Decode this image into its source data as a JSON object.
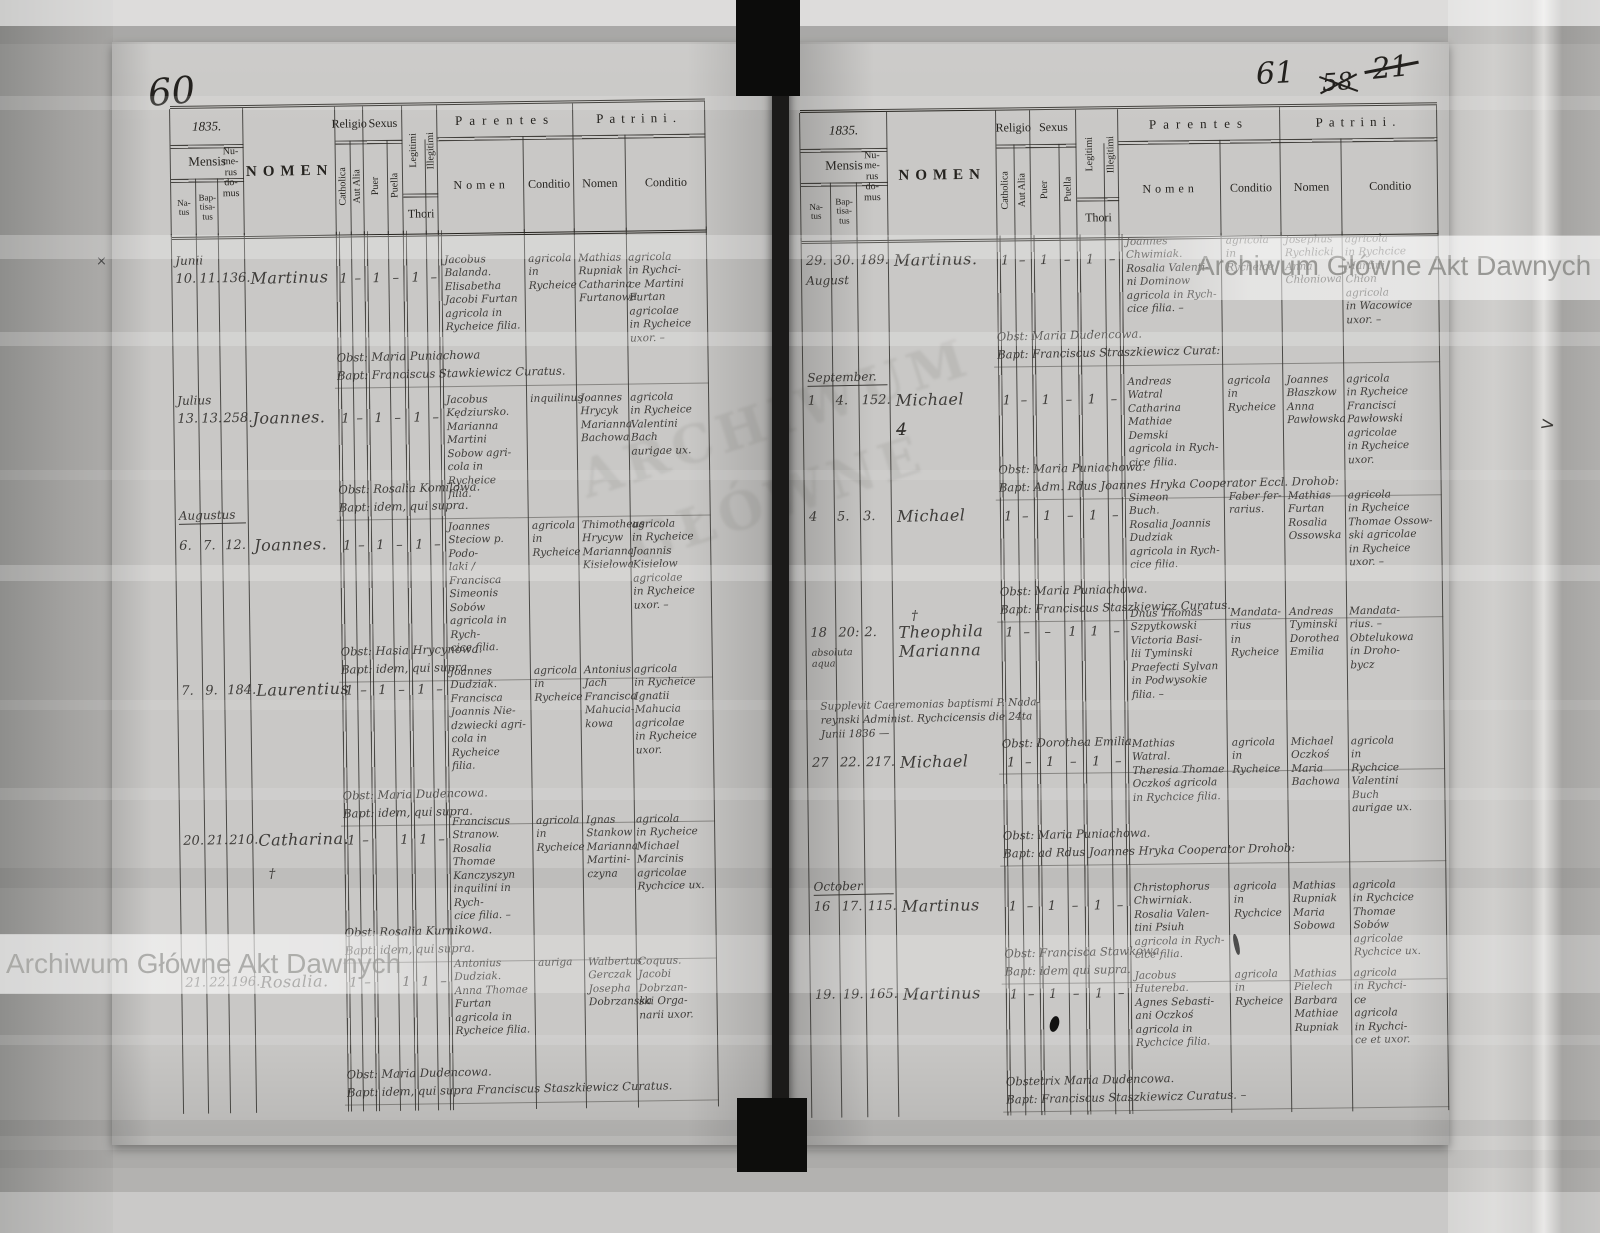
{
  "document": {
    "kind": "scanned parish baptism register, two-page spread",
    "watermark": "Archiwum Główne Akt Dawnych",
    "stamp_text": "ARCHIWUM\nGŁÓWNE",
    "page_numbers": {
      "left": "60",
      "right": "61",
      "right_old_crossed": "58",
      "right_old2_crossed": "21"
    },
    "marks": {
      "pencil_x": "×",
      "crossed_numeral": "4̶",
      "edge_mark": ">"
    },
    "header": {
      "mensis": "Mensis",
      "natus": "Na-\ntus",
      "baptisatus": "Bap-\ntisa-\ntus",
      "numerus": "Nu-\nme-\nrus\ndo-\nmus",
      "nomen": "NOMEN",
      "religio": "Religio",
      "catholica": "Catholica",
      "aut_alia": "Aut Alia",
      "sexus": "Sexus",
      "puer": "Puer",
      "puella": "Puella",
      "legitimi": "Legitimi",
      "illegitimi": "Illegitimi",
      "thori": "Thori",
      "parentes": "Parentes",
      "patrini": "Patrini.",
      "sub_nomen": "Nomen",
      "sub_conditio": "Conditio"
    },
    "pages": {
      "left": {
        "year": "1835.",
        "records": [
          {
            "month": "Junii",
            "month_top": 20,
            "natus": "10.",
            "bapt": "11.",
            "house": "136.",
            "name": "Martinus",
            "num_top": 38,
            "flags": [
              "1",
              "–",
              "1",
              "–",
              "1",
              "–"
            ],
            "par_nomen": "Jacobus\nBalanda.\nElisabetha\nJacobi Furtan\nagricola in\nRycheice filia.",
            "par_cond": "agricola\nin\nRycheice",
            "pat_nomen": "Mathias\nRupniak\nCatharina\nFurtanowa",
            "pat_cond": "agricola\nin Rychci-\nce Martini\nFurtan\nagricolae\nin Rycheice\nuxor. –",
            "note": "Obst: Maria Puniachowa\nBapt: Franciscus Stawkiewicz Curatus.",
            "note_top": 118
          },
          {
            "month": "Julius",
            "month_top": 160,
            "natus": "13.",
            "bapt": "13.",
            "house": "258.",
            "name": "Joannes.",
            "num_top": 178,
            "flags": [
              "1",
              "–",
              "1",
              "–",
              "1",
              "–"
            ],
            "par_nomen": "Jacobus\nKędziursko.\nMarianna\nMartini\nSobow agri-\ncola in Rycheice\nfilia.",
            "par_cond": "inquilinus",
            "pat_nomen": "Joannes\nHrycyk\nMarianna\nBachowa",
            "pat_cond": "agricola\nin Rycheice\nValentini\nBach\naurigae ux.",
            "note": "Obst: Rosalia Komilowa.\nBapt: idem, qui supra.",
            "note_top": 250
          },
          {
            "month": "Augustus",
            "month_ul": true,
            "month_top": 275,
            "natus": "6.",
            "bapt": "7.",
            "house": "12.",
            "name": "Joannes.",
            "num_top": 305,
            "flags": [
              "1",
              "–",
              "1",
              "–",
              "1",
              "–"
            ],
            "par_nomen": "Joannes\nSteciow p. Podo-\nlaki /\nFrancisca\nSimeonis\nSobów\nagricola in Rych-\ncice filia.",
            "par_cond": "agricola\nin\nRycheice",
            "pat_nomen": "Thimotheus\nHrycyw\nMarianna\nKisielowa",
            "pat_cond": "agricola\nin Rycheice\nJoannis\nKisielow\nagricolae\nin Rycheice\nuxor. –",
            "note": "Obst: Hasia Hrycynowa.\nBapt: idem, qui supra.",
            "note_top": 412
          },
          {
            "natus": "7.",
            "bapt": "9.",
            "house": "184.",
            "name": "Laurentius",
            "num_top": 450,
            "flags": [
              "1",
              "–",
              "1",
              "–",
              "1",
              "–"
            ],
            "par_nomen": "Joannes\nDudziak.\nFrancisca\nJoannis Nie-\ndzwiecki agri-\ncola in Rycheice\nfilia.",
            "par_cond": "agricola\nin\nRycheice",
            "pat_nomen": "Antonius\nJach\nFrancisca\nMahucia-\nkowa",
            "pat_cond": "agricola\nin Rycheice\nIgnatii\nMahucia\nagricolae\nin Rycheice\nuxor.",
            "note": "Obst: Maria Dudencowa.\nBapt: idem, qui supra.",
            "note_top": 556
          },
          {
            "natus": "20.",
            "bapt": "21.",
            "house": "210.",
            "name": "Catharina.",
            "num_top": 600,
            "cross": "†",
            "cross_pos": "below",
            "flags": [
              "1",
              "–",
              "",
              "1",
              "1",
              "–"
            ],
            "par_nomen": "Franciscus\nStranow.\nRosalia Thomae\nKanczyszyn\ninquilini in Rych-\ncice filia. –",
            "par_cond": "agricola\nin\nRycheice",
            "pat_nomen": "Ignas\nStankow\nMarianna\nMartini-\nczyna",
            "pat_cond": "agricola\nin Rycheice\nMichael\nMarcinis\nagricolae\nRychcice ux.",
            "note": "Obst: Rosalia Kurnikowa.\nBapt: idem, qui supra.",
            "note_top": 693
          },
          {
            "natus": "21.",
            "bapt": "22.",
            "house": "196.",
            "name": "Rosalia.",
            "num_top": 742,
            "flags": [
              "1",
              "–",
              "",
              "1",
              "1",
              "–"
            ],
            "par_nomen": "Antonius\nDudziak.\nAnna Thomae\nFurtan\nagricola in\nRycheice filia.",
            "par_cond": "auriga",
            "pat_nomen": "Walbertus\nGerczak\nJosepha\nDobrzanska",
            "pat_cond": "Coquus.\nJacobi\nDobrzan-\nski Orga-\nnarii uxor.",
            "note": "Obst: Maria Dudencowa.\nBapt: idem, qui supra Franciscus Staszkiewicz Curatus.",
            "note_top": 835
          }
        ]
      },
      "right": {
        "year": "1835.",
        "records": [
          {
            "natus": "29.",
            "bapt": "30.",
            "month": "August",
            "month_top": 36,
            "house": "189.",
            "name": "Martinus.",
            "num_top": 16,
            "flags": [
              "1",
              "–",
              "1",
              "–",
              "1",
              "–"
            ],
            "par_nomen": "Joannes\nChwimiak.\nRosalia Valenti-\nni Dominow\nagricola in Rych-\ncice filia. –",
            "par_cond": "agricola\nin\nRycheice",
            "pat_nomen": "Josephus\nRychlicki\nAnna\nChłoniowa",
            "pat_cond": "agricola\nin Rychcice\nMartini\nChłon\nagricola\nin Wacowice\nuxor. –",
            "note": "Obst: Maria Dudencowa.\nBapt: Franciscus Straszkiewicz Curat:",
            "note_top": 93
          },
          {
            "month": "September.",
            "month_ul": true,
            "month_top": 133,
            "natus": "1",
            "bapt": "4.",
            "house": "152.",
            "name": "Michael",
            "num_top": 156,
            "flags": [
              "1",
              "–",
              "1",
              "–",
              "1",
              "–"
            ],
            "par_nomen": "Andreas\nWatral\nCatharina\nMathiae\nDemski\nagricola in Rych-\ncice filia.",
            "par_cond": "agricola\nin\nRycheice",
            "pat_nomen": "Joannes\nBłaszkow\nAnna\nPawłowska",
            "pat_cond": "agricola\nin Rycheice\nFrancisci\nPawłowski\nagricolae\nin Rycheice\nuxor.",
            "note": "Obst: Maria Puniachowa.\nBapt: Adm. Rdus Joannes Hryka Cooperator Eccl. Drohob:",
            "note_top": 226
          },
          {
            "natus": "4",
            "bapt": "5.",
            "house": "3.",
            "name": "Michael",
            "num_top": 272,
            "flags": [
              "1",
              "–",
              "1",
              "–",
              "1",
              "–"
            ],
            "par_nomen": "Simeon\nBuch.\nRosalia Joannis\nDudziak\nagricola in Rych-\ncice filia.",
            "par_cond": "Faber fer-\nrarius.",
            "pat_nomen": "Mathias\nFurtan\nRosalia\nOssowska",
            "pat_cond": "agricola\nin Rycheice\nThomae Ossow-\nski agricolae\nin Rycheice\nuxor. –",
            "note": "Obst: Maria Puniachowa.\nBapt: Franciscus Staszkiewicz Curatus.",
            "note_top": 348
          },
          {
            "natus": "18",
            "bapt": "20:",
            "house": "2.",
            "name": "Theophila\nMarianna",
            "num_top": 388,
            "cross": "†",
            "cross_pos": "above",
            "dates_note": "absoluta\naqua",
            "flags": [
              "1",
              "–",
              "–",
              "1",
              "1",
              "–"
            ],
            "par_nomen": "Dnus Thomas\nSzpytkowski\nVictoria Basi-\nlii Tyminski\nPraefecti Sylvan\nin Podwysokie\nfilia. –",
            "par_cond": "Mandata-\nrius\nin Rycheice",
            "pat_nomen": "Andreas\nTyminski\nDorothea\nEmilia",
            "pat_cond": "Mandata-\nrius. –\nObtelukowa\nin Droho-\nbycz",
            "subnote": "Supplevit Caeremonias baptismi P. Nada-\nreynski Administ. Rychcicensis die 24ta\nJunii 1836 —",
            "subnote_top": 462,
            "note": "Obst: Dorothea Emilia.",
            "note_top": 500
          },
          {
            "natus": "27",
            "bapt": "22.",
            "house": "217.",
            "name": "Michael",
            "num_top": 518,
            "flags": [
              "1",
              "–",
              "1",
              "–",
              "1",
              "–"
            ],
            "par_nomen": "Mathias\nWatral.\nTheresia Thomae\nOczkoś agricola\nin Rychcice filia.",
            "par_cond": "agricola\nin\nRycheice",
            "pat_nomen": "Michael\nOczkoś\nMaria\nBachowa",
            "pat_cond": "agricola\nin\nRychcice\nValentini\nBuch\naurigae ux.",
            "note": "Obst: Maria Puniachowa.\nBapt: ad Rdus Joannes Hryka Cooperator Drohob:",
            "note_top": 592
          },
          {
            "month": "October",
            "month_ul": true,
            "month_top": 642,
            "natus": "16",
            "bapt": "17.",
            "house": "115.",
            "name": "Martinus",
            "num_top": 662,
            "flags": [
              "1",
              "–",
              "1",
              "–",
              "1",
              "–"
            ],
            "par_nomen": "Christophorus\nChwirniak.\nRosalia Valen-\ntini Psiuh\nagricola in Rych-\ncice filia.",
            "par_cond": "agricola\nin\nRychcice",
            "pat_nomen": "Mathias\nRupniak\nMaria\nSobowa",
            "pat_cond": "agricola\nin Rychcice\nThomae\nSobów\nagricolae\nRychcice ux.",
            "note": "Obst: Francisca Stawkowa.\nBapt: idem qui supra.",
            "note_top": 710
          },
          {
            "natus": "19.",
            "bapt": "19.",
            "house": "165.",
            "name": "Martinus",
            "num_top": 750,
            "flags": [
              "1",
              "–",
              "1",
              "–",
              "1",
              "–"
            ],
            "par_nomen": "Jacobus\nHutereba.\nAgnes Sebasti-\nani Oczkoś\nagricola in\nRychcice filia.",
            "par_cond": "agricola\nin\nRycheice",
            "pat_nomen": "Mathias\nPielech\nBarbara\nMathiae\nRupniak",
            "pat_cond": "agricola\nin Rychci-\nce\nagricola\nin Rychci-\nce et uxor.",
            "note": "Obstetrix Maria Dudencowa.\nBapt: Franciscus Staszkiewicz Curatus. –",
            "note_top": 838
          }
        ]
      }
    }
  }
}
